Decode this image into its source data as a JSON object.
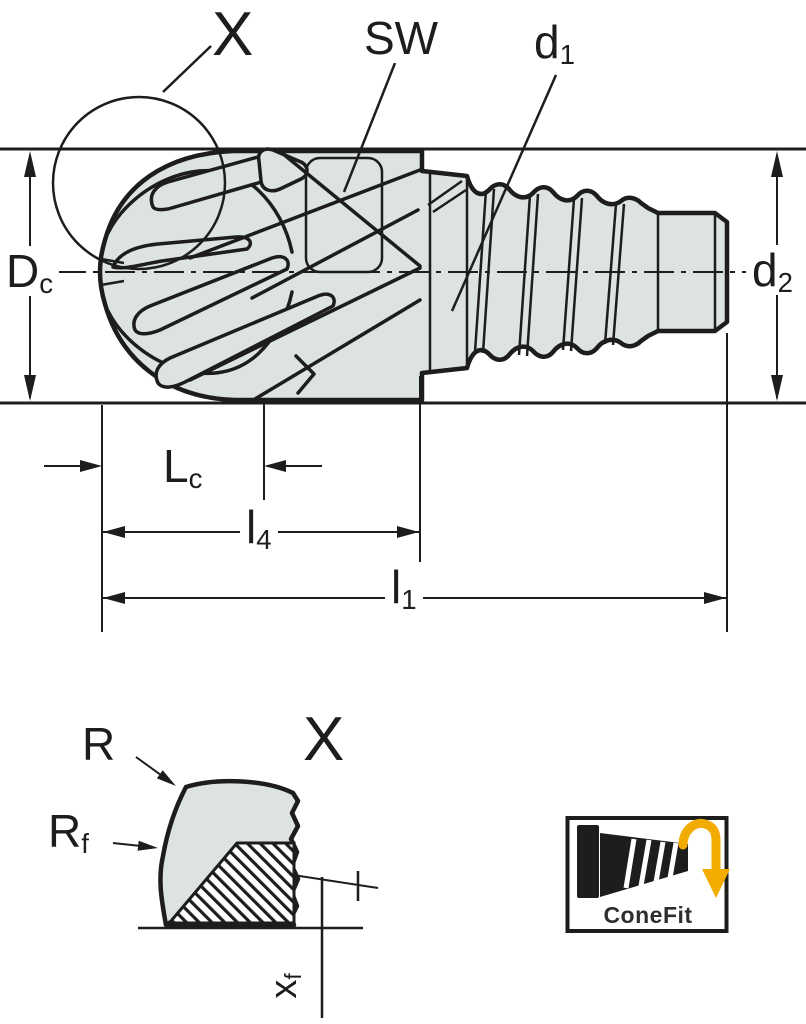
{
  "drawing": {
    "title": "Exchangeable milling head technical drawing",
    "labels": {
      "detail_ref": {
        "base": "X",
        "sub": ""
      },
      "wrench_size": {
        "base": "SW",
        "sub": ""
      },
      "thread_diameter": {
        "base": "d",
        "sub": "1"
      },
      "cutting_diameter": {
        "base": "D",
        "sub": "c"
      },
      "adapter_diameter": {
        "base": "d",
        "sub": "2"
      },
      "cutting_length": {
        "base": "L",
        "sub": "c"
      },
      "length_l4": {
        "base": "l",
        "sub": "4"
      },
      "length_l1": {
        "base": "l",
        "sub": "1"
      },
      "corner_radius": {
        "base": "R",
        "sub": ""
      },
      "face_radius": {
        "base": "R",
        "sub": "f"
      },
      "detail_title": {
        "base": "X",
        "sub": ""
      },
      "chamfer_width": {
        "base": "x",
        "sub": "f"
      }
    },
    "logo": {
      "label": "ConeFit",
      "icon": "rotation-down-arrow-icon"
    },
    "colors": {
      "line": "#1d1d1b",
      "body": "#dce3e2",
      "label_bg": "#ffffff",
      "accent": "#f2ab00",
      "logo_text": "#2e2e2e",
      "background": "#ffffff"
    }
  }
}
